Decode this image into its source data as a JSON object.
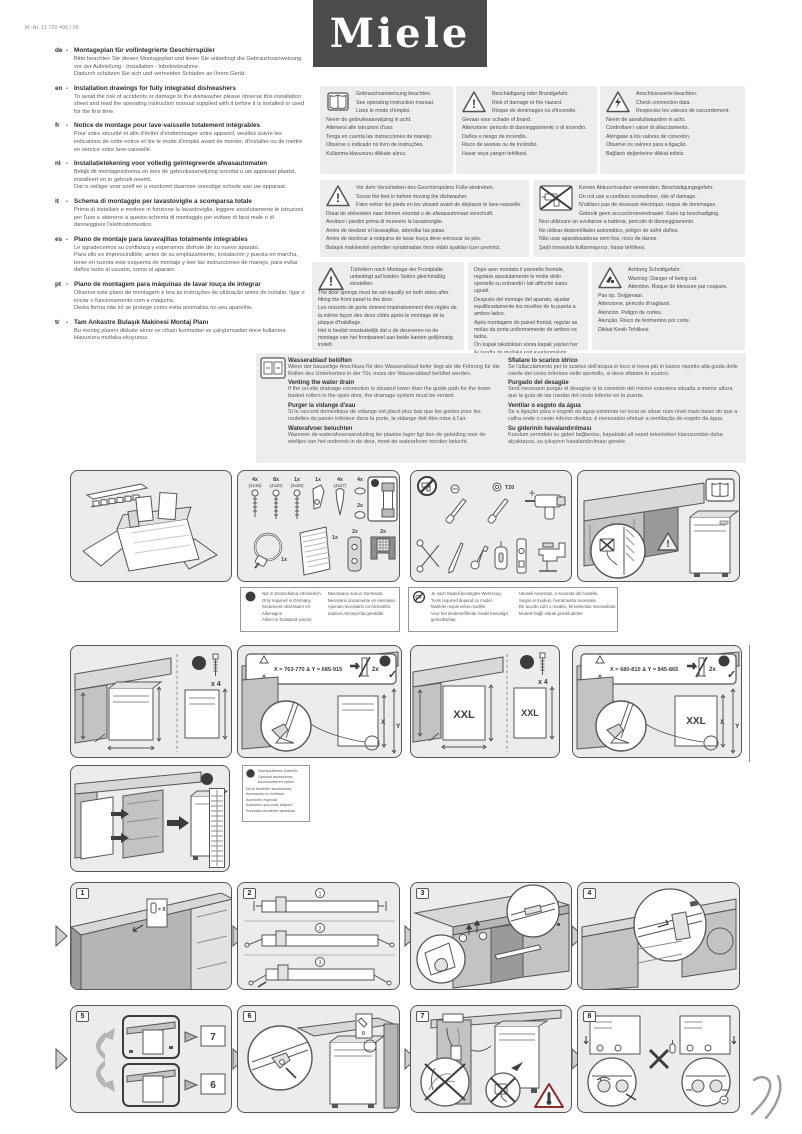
{
  "page": {
    "part_number": "M.-Nr. 11 720 490 / 00",
    "brand": "Miele"
  },
  "colors": {
    "logo_bg": "#4b4b4d",
    "panel_bg": "#ececee",
    "panel_border": "#55555a",
    "box_bg": "#ededee"
  },
  "intro": [
    {
      "lang": "de",
      "title": "Montageplan für vollintegrierte Geschirrspüler",
      "body": "Bitte beachten Sie diesen Montageplan und lesen Sie unbedingt die Gebrauchsanweisung vor der Aufstellung - Installation - Inbetriebnahme.\nDadurch schützen Sie sich und vermeiden Schäden an Ihrem Gerät."
    },
    {
      "lang": "en",
      "title": "Installation drawings for fully integrated dishwashers",
      "body": "To avoid the risk of accidents or damage to the dishwasher please observe this installation sheet and read the operating instruction manual supplied with it before it is installed or used for the first time."
    },
    {
      "lang": "fr",
      "title": "Notice de montage pour lave-vaisselle totalement intégrables",
      "body": "Pour votre sécurité et afin d'éviter d'endommager votre appareil, veuillez suivre les indications de cette notice et lire le mode d'emploi avant de monter, d'installer ou de mettre en service votre lave-vaisselle."
    },
    {
      "lang": "nl",
      "title": "Installatietekening voor volledig geïntegreerde afwasautomaten",
      "body": "Bekijk dit montageschema en lees de gebruiksaanwijzing voordat u uw apparaat plaatst, installeert en in gebruik neemt.\nDat is veiliger voor uzelf en u voorkomt daarmee onnodige schade aan uw apparaat."
    },
    {
      "lang": "it",
      "title": "Schema di montaggio per lavastoviglie a scomparsa totale",
      "body": "Prima di installare e mettere in funzione la lavastoviglia, leggere assolutamente le istruzioni per l'uso e attenersi a questo schema di montaggio per evitare di farsi male o di danneggiare l'elettrodomestico."
    },
    {
      "lang": "es",
      "title": "Plano de montaje para lavavajillas totalmente integrables",
      "body": "Le agradecemos su confianza y esperamos disfrute de su nuevo aparato.\nPara ello es imprescindible, antes de su emplazamiento, instalación y puesta en marcha, tener en cuenta este esquema de montaje y leer las instrucciones de manejo, para evitar daños tanto al usuario, como al aparato."
    },
    {
      "lang": "pt",
      "title": "Plano de montagem para máquinas de lavar louça de integrar",
      "body": "Observe este plano de montagem e leia as instruções de utilização antes de instalar, ligar e iniciar o funcionamento com a máquina.\nDesta forma não só se protege como evita anomalias no seu aparelho."
    },
    {
      "lang": "tr",
      "title": "Tam Ankastre Bulaşık Makinesi Montaj Planı",
      "body": "Bu montaj planını dikkate alınız ve cihazı kurmadan ve çalıştırmadan önce kullanma klavuzunu mutlaka okuyunuz."
    }
  ],
  "warnings": {
    "manual": {
      "lines": [
        "Gebrauchsanweisung beachten.",
        "See operating instruction manual.",
        "Lisez le mode d'emploi.",
        "Neem de gebruiksaanwijzing in acht.",
        "Attenersi alle istruzioni d'uso.",
        "Tenga en cuenta las instrucciones de manejo.",
        "Observe o indicado no livro de instruções.",
        "Kullanma klavuzunu dikkate alınız."
      ]
    },
    "fire": {
      "lines": [
        "Beschädigung oder Brandgefahr.",
        "Risk of damage or fire hazard.",
        "Risque de dommages ou d'incendie.",
        "Gevaar voor schade of brand.",
        "Attenzione: pericolo di danneggiamento o di incendio.",
        "Daños o riesgo de incendio.",
        "Risco de avarias ou de incêndio.",
        "Hasar veya yangın tehlikesi."
      ]
    },
    "connection": {
      "lines": [
        "Anschlusswerte beachten.",
        "Check connection data.",
        "Respectez les valeurs de raccordement.",
        "Neem de aansluitwaarden in acht.",
        "Controllare i valori di allacciamento.",
        "Aténgase a los valores de conexión.",
        "Observe os valores para a ligação.",
        "Bağlantı değerlerine dikkat ediniz."
      ]
    },
    "feet": {
      "lines": [
        "Vor dem Verschieben des Geschirrspülers Füße eindrehen.",
        "Screw the feet in before moving the dishwasher.",
        "Faire entrer les pieds en les vissant avant de déplacer le lave-vaisselle.",
        "Draai de stelvoeten naar binnen voordat u de afwasautomaat verschuift.",
        "Avvitare i piedini prima di muovere la lavastoviglie.",
        "Antes de deslizar el lavavajillas, atornillar las patas.",
        "Antes de deslocar a máquina de lavar louça deve enroscar os pés.",
        "Bulaşık makinesini yerinden oynatmadan önce vidalı ayakları içeri çeviriniz."
      ]
    },
    "no_cordless": {
      "lines": [
        "Keinen Akkuschrauber verwenden, Beschädigungsgefahr.",
        "Do not use a cordless screwdriver, risk of damage.",
        "N'utilisez pas de visseuse électrique, risque de dommages.",
        "Gebruik geen accuschroevendraaier. Kans op beschadiging.",
        "Non utilizzare un avvitatore a batteria, pericolo di danneggiamento.",
        "No utilizar destornillador automático, peligro de sufrir daños.",
        "Não usar aparafusadoras sem fios, risco de danos.",
        "Şarjlı tornavida kullanmayınız, hasar tehlikesi."
      ]
    },
    "springs_a": {
      "lines": [
        "Türfedern nach Montage der Frontplatte unbedingt auf beiden Seiten gleichmäßig einstellen.",
        "The door springs must be set equally on both sides after fitting the front panel to the door.",
        "Les ressorts de porte doivent impérativement être réglés de la même façon des deux côtés après le montage de la plaque d'habillage.",
        "Het is beslist noodzakelijk dat u de deurveren na de montage van het frontpaneel aan beide kanten gelijkmatig instelt."
      ]
    },
    "springs_b": {
      "lines": [
        "Dopo aver montato il pannello frontale, regolare assolutamente le molle dello sportello su entrambi i lati affinché siano uguali.",
        "Después del montaje del aparato, ajustar equilibradamente los muelles de la puerta a ambos lados.",
        "Após montagem do painel frontal, regular as molas da porta uniformemente de ambos os lados.",
        "Ön kapak takıldıktan sonra kapak yayları her iki tarafta da mutlaka eşit ayarlanmalıdır."
      ]
    },
    "cut": {
      "lines": [
        "Achtung Schnittgefahr.",
        "Warning: Danger of being cut.",
        "Attention. Risque de blessure par coupure.",
        "Pas op. Snijgevaar.",
        "Attenzione, pericolo di tagliarsi.",
        "Atención. Peligro de cortes.",
        "Atenção. Risco de ferimentos por corte.",
        "Dikkat Kesik Tehlikesi."
      ]
    }
  },
  "drain": {
    "left": [
      {
        "title": "Wasserablauf belüften",
        "body": "Wenn der bauseitige Anschluss für den Wasserablauf tiefer liegt als die Führung für die Rollen des Unterkorbes in der Tür, muss der Wasserablauf belüftet werden."
      },
      {
        "title": "Venting the water drain",
        "body": "If the on-site drainage connection is situated lower than the guide path for the lower basket rollers in the open door, the drainage system must be vented."
      },
      {
        "title": "Purger la vidange d'eau",
        "body": "Si le raccord domestique de vidange est placé plus bas que les guides pour les roulettes du panier inférieur dans la porte, la vidange doit être mise à l'air."
      },
      {
        "title": "Waterafvoer beluchten",
        "body": "Wanneer de waterafvoeraansluiting ter plaatse lager ligt dan de geleiding voor de wieltjes van het onderrek in de deur, moet de waterafvoer worden belucht."
      }
    ],
    "right": [
      {
        "title": "Sfiatare lo scarico idrico",
        "body": "Se l'allacciamento per lo scarico dell'acqua in loco si trova più in basso rispetto alla guida delle rotelle del cesto inferiore nello sportello, si deve sfiatare lo scarico."
      },
      {
        "title": "Purgado del desagüe",
        "body": "Será necesario purgar el desagüe si la conexión del mismo estuviera situada a menor altura que la guía de las ruedas del cesto inferior en la puerta."
      },
      {
        "title": "Ventilar o esgoto da água",
        "body": "Se a ligação para o esgoto da água existente no local se situar num nível mais baixo do que a calha onde o cesto inferior desliza, é necessário efetuar a ventilação do esgoto da água."
      },
      {
        "title": "Su giderinin havalandırılması",
        "body": "Kurulum yerindeki su gideri bağlantısı, kapaktaki alt sepet tekerlekleri klavuzundan daha alçaktaysa, su çıkışının havalandırılması gerekir."
      }
    ]
  },
  "notes": {
    "germany": {
      "badge": "D",
      "lines": [
        "Nur in Deutschland erforderlich.",
        "Only required in Germany.",
        "Seulement nécessaire en Allemagne.",
        "Alleen in Duitsland vereist.",
        "Necessario solo in Germania.",
        "Necesario únicamente en Alemania.",
        "Apenas necessário na Alemanha.",
        "Sadece Almanya'da gereklidir."
      ]
    },
    "tools": {
      "lines": [
        "Je nach Modell benötigtes Werkzeug.",
        "Tools required depend on model.",
        "Matériel requis selon modèle.",
        "Voor het desbetreffende model benodigd gereedschap.",
        "Utensili necessari, a seconda del modello.",
        "Según el modelo, herramienta necesaria.",
        "De acordo com o modelo, ferramentas necessárias.",
        "Modele bağlı olarak gerekli aletler."
      ]
    },
    "accessories": {
      "badge": "M",
      "lines": [
        "Nachkaufbares Zubehör.",
        "Optional accessories.",
        "Accessoires en option.",
        "Na te bestellen accessoires.",
        "Accessorio su richiesta.",
        "Accesorio especial.",
        "Acessório que pode adquirir.",
        "Sonradan alınabilen aksesuar."
      ]
    }
  },
  "fittings": {
    "d_badge": "D",
    "screw1_qty": "4x",
    "screw1_size": "(4x15)",
    "screw2_qty": "8x",
    "screw2_size": "(4x20)",
    "screw3_qty": "1x",
    "screw3_size": "(4x20)",
    "bracket_qty": "1x",
    "plug_qty": "4x",
    "plug_size": "(4x27)",
    "cap_large_qty": "4x",
    "cap_small_qty": "2x",
    "tube_qty": "1x",
    "clamp_qty": "1x",
    "sheet_qty": "1x",
    "holder_qty": "2x",
    "grille_qty": "2x"
  },
  "tools_panel": {
    "torx_label": "T20"
  },
  "dimensions": {
    "m_badge": "M",
    "screws_count": "x 4",
    "std_banner": "X = 763-770 & Y = 685-915",
    "xxl_banner": "X = 680-810 & Y = 845-865",
    "feet_count": "2x",
    "check": "✓",
    "size_label": "XXL",
    "x_label": "X",
    "y_label": "Y"
  },
  "steps": {
    "badges": [
      "1",
      "2",
      "3",
      "4",
      "5",
      "6",
      "7",
      "8"
    ],
    "substeps": [
      "1",
      "2",
      "3"
    ],
    "template_label": "= X",
    "zero_label": "0",
    "option_top": "7",
    "option_bottom": "6"
  }
}
